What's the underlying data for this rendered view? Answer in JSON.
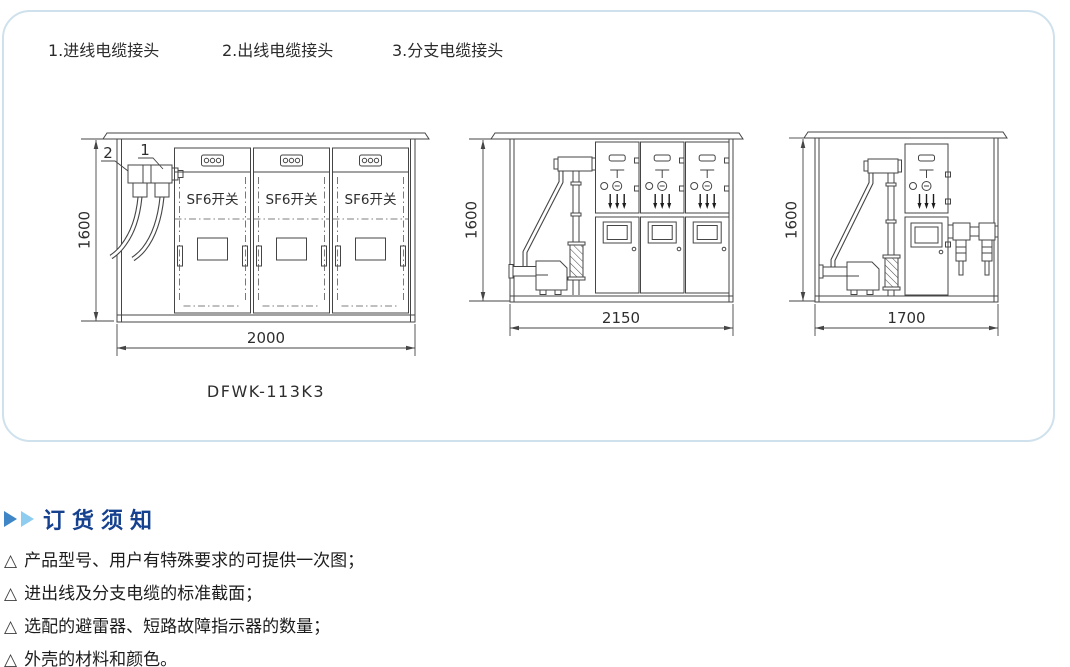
{
  "legend": {
    "items": [
      {
        "label": "1.进线电缆接头"
      },
      {
        "label": "2.出线电缆接头"
      },
      {
        "label": "3.分支电缆接头"
      }
    ]
  },
  "drawings": {
    "front_view": {
      "model": "DFWK-113K3",
      "height_dim": "1600",
      "width_dim": "2000",
      "switch_label": "SF6开关",
      "callout_incoming": "1",
      "callout_outgoing": "2"
    },
    "side_view_mid": {
      "height_dim": "1600",
      "width_dim": "2150"
    },
    "side_view_right": {
      "height_dim": "1600",
      "width_dim": "1700"
    }
  },
  "ordering": {
    "title": "订货须知",
    "bullet": "△",
    "items": [
      "产品型号、用户有特殊要求的可提供一次图；",
      "进出线及分支电缆的标准截面；",
      "选配的避雷器、短路故障指示器的数量；",
      "外壳的材料和颜色。"
    ]
  },
  "colors": {
    "panel_border": "#cfe1ec",
    "drawing_line": "#454545",
    "title_blue": "#15418f",
    "arrow_dark_blue": "#3e86c6",
    "arrow_light_blue": "#8ecdf0"
  }
}
